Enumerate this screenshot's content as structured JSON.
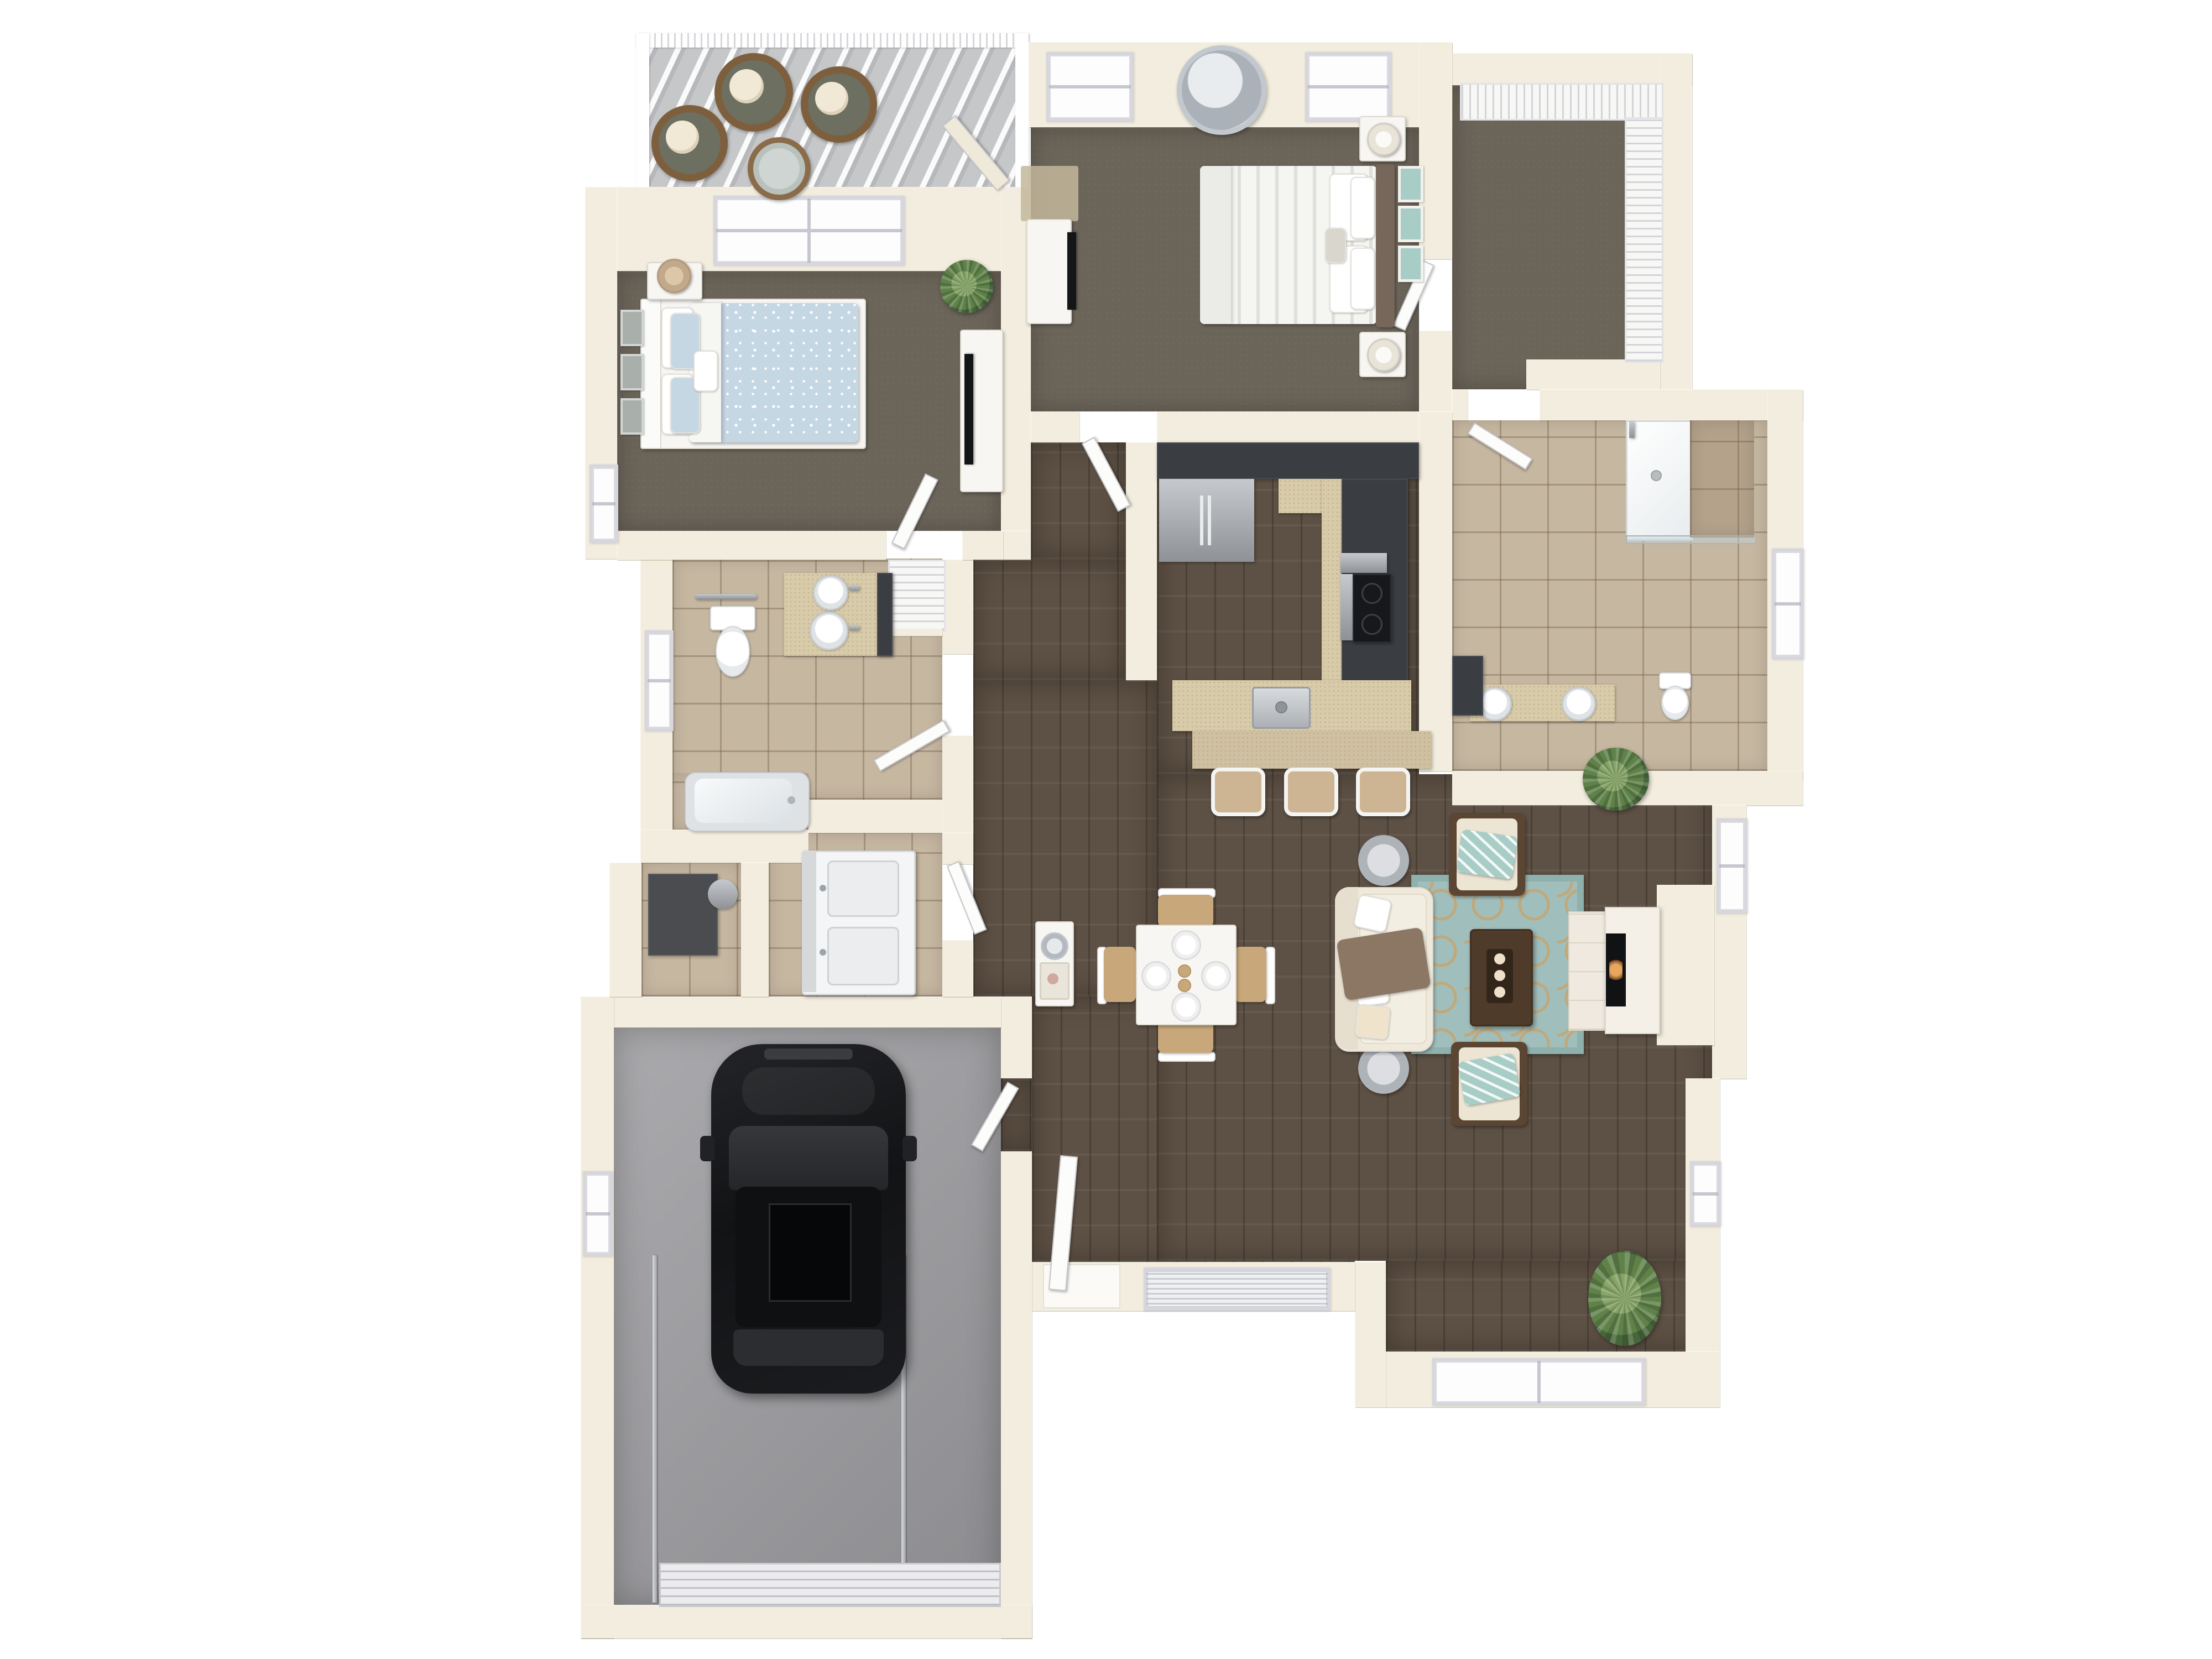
{
  "title": "3D top-view floor plan rendering of a one-story apartment home with attached garage",
  "colors": {
    "wall": "#f2edde",
    "carpet": "#6b6459",
    "wood": "#5d5044",
    "tile": "#c6b7a1",
    "garage_floor": "#9c9ca0",
    "patio_floor": "#c6c7c9",
    "cabinet": "#3a3d42",
    "counter": "#d8cba9",
    "rug_teal": "#9fbebc",
    "rug_tan": "#c2a878",
    "accent_teal": "#a7cdc6",
    "bed_blue": "#c6d7e4",
    "throw_brown": "#8b7763",
    "car": "#17181a"
  },
  "rooms": {
    "patio": {
      "label": "Patio",
      "items": [
        "slatted shade cover",
        "white railing",
        "3 wicker chairs with cream cushions",
        "round bistro table",
        "sliding door to bedroom"
      ]
    },
    "bedroom2": {
      "label": "Bedroom 2",
      "items": [
        "queen bed with blue floral duvet",
        "white headboard",
        "starfish accent pillow",
        "nightstand with tan drum lamp",
        "3 wall frames",
        "dresser with TV",
        "potted plant",
        "window"
      ]
    },
    "master_bedroom": {
      "label": "Master Bedroom",
      "items": [
        "king bed with white striped duvet",
        "wood headboard",
        "3 teal art panels",
        "2 nightstands with white lamps",
        "TV console with TV",
        "tan rug",
        "round sunburst mirror",
        "2 windows"
      ]
    },
    "walk_in_closet": {
      "label": "Walk-in Closet",
      "items": [
        "wire shelving on two walls"
      ]
    },
    "master_bathroom": {
      "label": "Master Bathroom",
      "items": [
        "walk-in shower with glass door and tiled bench",
        "double vanity with 2 round sinks",
        "toilet",
        "dark linen cabinet",
        "window"
      ]
    },
    "kitchen": {
      "label": "Kitchen",
      "items": [
        "charcoal U-shaped cabinets",
        "stainless refrigerator",
        "range with cooktop",
        "granite counters",
        "island with stainless sink",
        "breakfast bar"
      ],
      "bar_stools": 3
    },
    "dining": {
      "label": "Dining Area",
      "items": [
        "square white table",
        "4 wood-seat chairs",
        "2 candles"
      ],
      "place_settings": 4
    },
    "living": {
      "label": "Living Room",
      "items": [
        "cream sofa with brown throw",
        "2 accent chairs with teal striped throws",
        "2 round silver side tables",
        "teal quatrefoil rug",
        "dark wood coffee table with candle tray",
        "fireplace with white mantel",
        "palm plant",
        "fern plant",
        "3 windows"
      ]
    },
    "hallway": {
      "label": "Hallway",
      "items": [
        "linen closet with slatted shelves",
        "white console table with round mirror and shell tray"
      ]
    },
    "hall_bathroom": {
      "label": "Hall Bathroom",
      "items": [
        "toilet with towel bar",
        "double-sink vanity",
        "bathtub",
        "window"
      ]
    },
    "laundry": {
      "label": "Laundry Closet",
      "items": [
        "stacked washer and dryer"
      ]
    },
    "utility": {
      "label": "Utility Closet",
      "items": [
        "furnace with duct"
      ]
    },
    "entry": {
      "label": "Entry Foyer",
      "items": [
        "front door",
        "window with blinds"
      ]
    },
    "garage": {
      "label": "Garage",
      "items": [
        "black SUV",
        "segmented garage door",
        "2 door tracks",
        "window"
      ],
      "cars": 1
    }
  },
  "counts": {
    "bedrooms": 2,
    "bathrooms": 2,
    "patio_chairs": 3,
    "bar_stools": 3,
    "dining_chairs": 4,
    "windows_total": 14
  }
}
